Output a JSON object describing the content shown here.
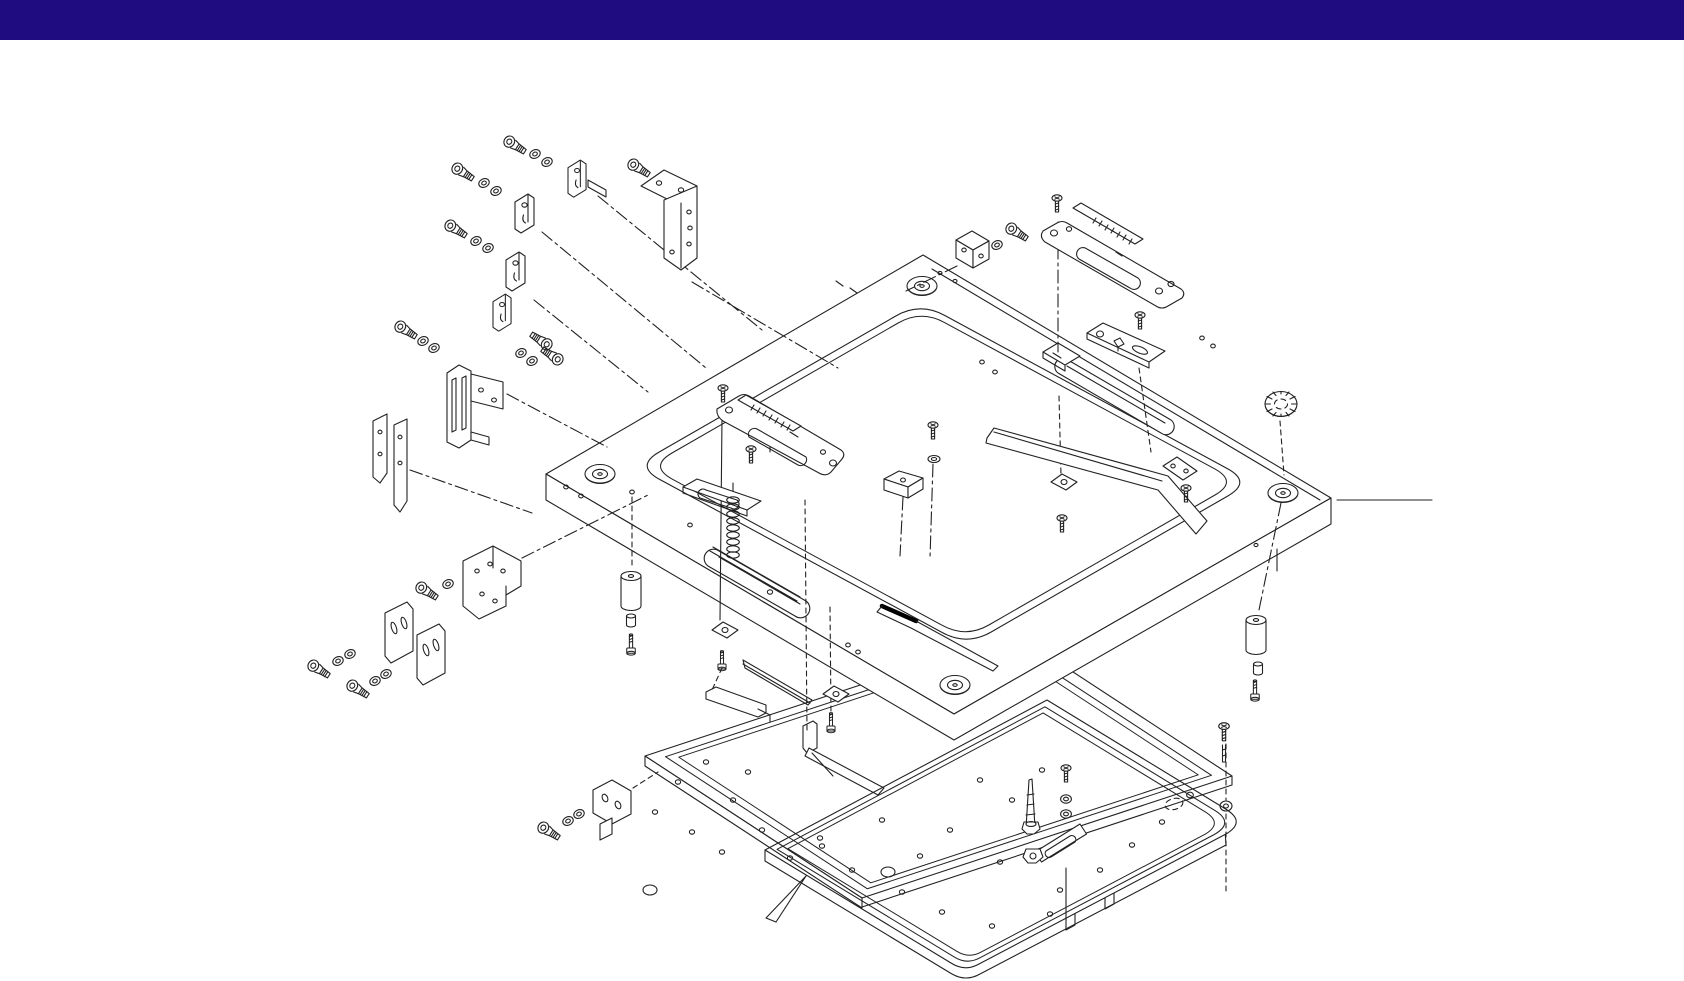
{
  "colors": {
    "header_bar": "#1f0c80",
    "canvas": "#ffffff",
    "line": "#222222",
    "wrench_black": "#000000"
  },
  "header": {
    "height_px": 40,
    "text": ""
  },
  "diagram": {
    "type": "exploded-assembly-parts-diagram",
    "parts": [
      {
        "name": "socket-head-cap-bolt",
        "qty": 13
      },
      {
        "name": "flat-washer",
        "qty": 20
      },
      {
        "name": "mounting-clip-plate",
        "qty": 4
      },
      {
        "name": "corner-angle-bracket",
        "qty": 1
      },
      {
        "name": "slide-channel-bracket",
        "qty": 1
      },
      {
        "name": "support-bar",
        "qty": 2
      },
      {
        "name": "stepped-z-bracket",
        "qty": 1
      },
      {
        "name": "slotted-shim-plate",
        "qty": 2
      },
      {
        "name": "l-mounting-bracket",
        "qty": 1
      },
      {
        "name": "main-frame-plate",
        "qty": 1
      },
      {
        "name": "corner-boss",
        "qty": 4
      },
      {
        "name": "slotted-adjustment-plate",
        "qty": 3
      },
      {
        "name": "scale-strip",
        "qty": 2
      },
      {
        "name": "clamp-block",
        "qty": 1
      },
      {
        "name": "square-washer-plate",
        "qty": 5
      },
      {
        "name": "flat-head-screw",
        "qty": 8
      },
      {
        "name": "coil-spring",
        "qty": 1
      },
      {
        "name": "guide-block",
        "qty": 1
      },
      {
        "name": "hex-key-wrench",
        "qty": 1
      },
      {
        "name": "knurled-nut",
        "qty": 1
      },
      {
        "name": "cylindrical-foot-spacer",
        "qty": 2
      },
      {
        "name": "foot-cap",
        "qty": 2
      },
      {
        "name": "foot-bolt",
        "qty": 2
      },
      {
        "name": "deflector-bar",
        "qty": 1
      },
      {
        "name": "base-tray-plate",
        "qty": 1
      },
      {
        "name": "base-bottom-plate",
        "qty": 1
      },
      {
        "name": "taper-pin",
        "qty": 1
      },
      {
        "name": "hex-nut",
        "qty": 1
      },
      {
        "name": "slotted-link-bar",
        "qty": 1
      },
      {
        "name": "angled-support-bar",
        "qty": 1
      }
    ]
  }
}
